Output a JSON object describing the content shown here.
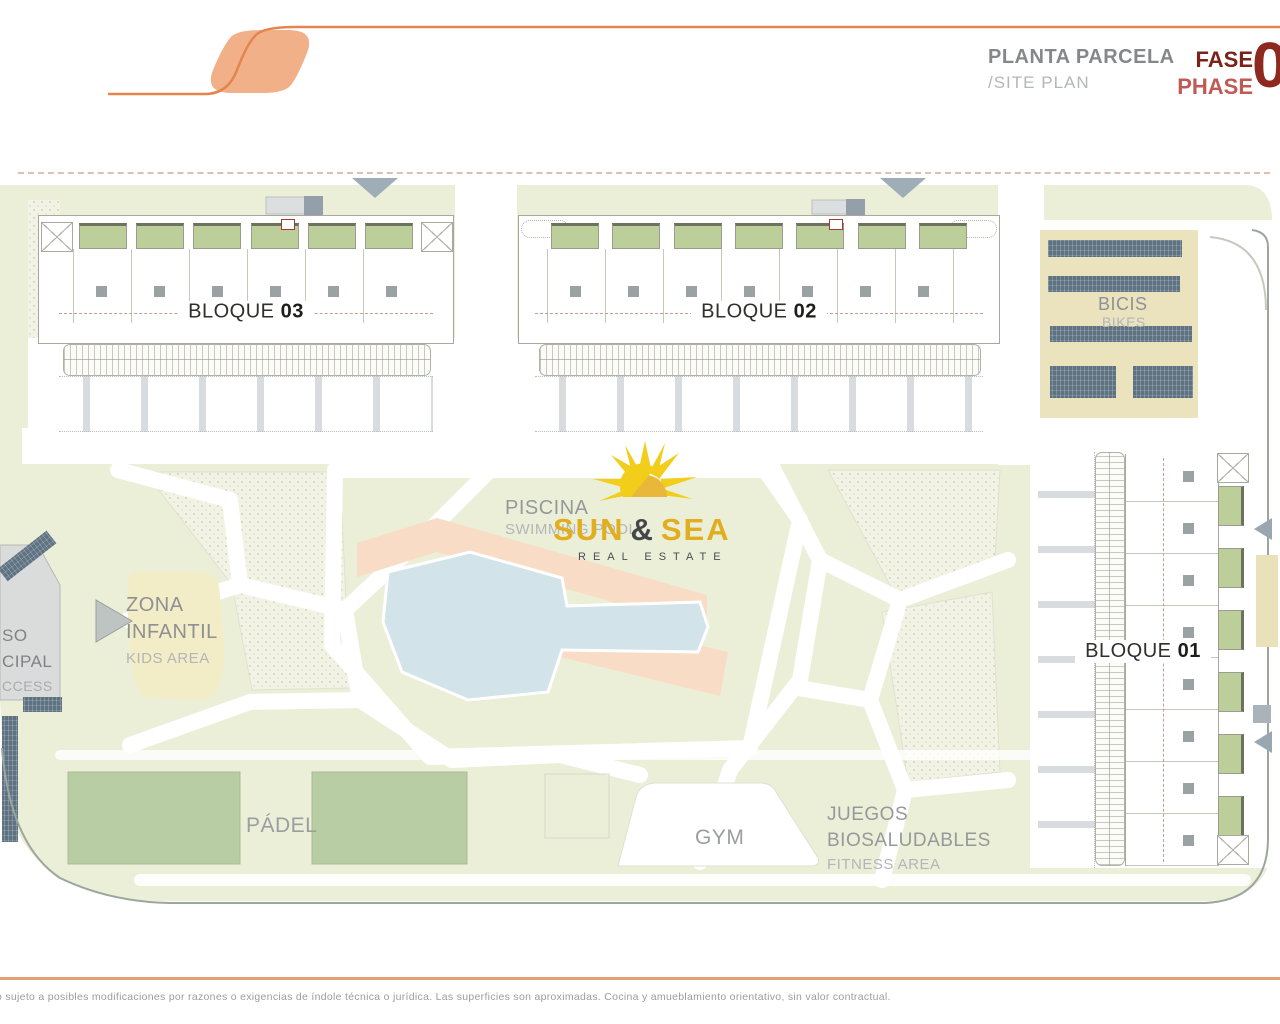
{
  "header": {
    "title_es": "PLANTA PARCELA",
    "title_en": "/SITE PLAN",
    "fase": "FASE",
    "phase": "PHASE",
    "phase_number": "0"
  },
  "blocks": {
    "b03": {
      "name": "BLOQUE",
      "number": "03"
    },
    "b02": {
      "name": "BLOQUE",
      "number": "02"
    },
    "b01": {
      "name": "BLOQUE",
      "number": "01"
    }
  },
  "areas": {
    "piscina": {
      "es": "PISCINA",
      "en": "SWIMMING POOL"
    },
    "zona_infantil": {
      "l1": "ZONA",
      "l2": "INFANTIL",
      "en": "KIDS AREA"
    },
    "padel": {
      "label": "PÁDEL"
    },
    "gym": {
      "label": "GYM"
    },
    "juegos": {
      "l1": "JUEGOS",
      "l2": "BIOSALUDABLES",
      "en": "FITNESS AREA"
    },
    "bicis": {
      "es": "BICIS",
      "en": "BIKES"
    }
  },
  "access": {
    "l1": "SO",
    "l2": "CIPAL",
    "l3": "CCESS"
  },
  "logo": {
    "sun": "SUN",
    "amp": "&",
    "sea": "SEA",
    "tagline": "REAL ESTATE"
  },
  "footer": {
    "disclaimer": "o sujeto a posibles modificaciones por razones o exigencias de índole técnica o jurídica. Las superficies son aproximadas. Cocina y amueblamiento orientativo, sin valor contractual."
  },
  "colors": {
    "accent_orange": "#F2B089",
    "line_orange": "#E5854E",
    "fase_dark": "#7B231A",
    "phase_red": "#C05A54",
    "lawn": "#ECEFD8",
    "terrace_green": "#BCCF9A",
    "court_green": "#B9CDA4",
    "pool_blue": "#D2E4EA",
    "deck_pink": "#F8DCC6",
    "sand_beige": "#EAE3BD",
    "rack_navy": "#5F7282",
    "sun_gold": "#E5B71F"
  }
}
